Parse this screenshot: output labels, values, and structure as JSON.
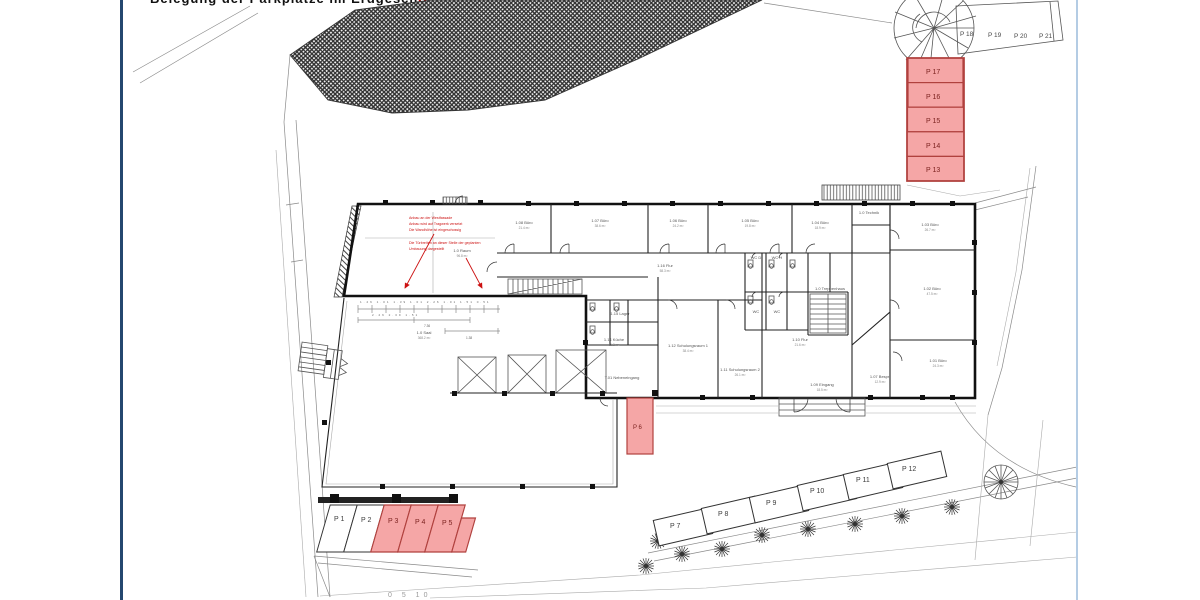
{
  "header": {
    "title_black_fragment": "Belegung der Parkplätze im Erdgeschoss,",
    "title_red_fragment": "rot markierte Stellplätze sind bereits vergeben",
    "scale_fragment": "0  5  10"
  },
  "colors": {
    "highlight_fill": "#f5a6a6",
    "highlight_stroke": "#b0413e",
    "highlight_text": "#7c2320",
    "annotation_red": "#cc1111",
    "left_border": "#24476f",
    "right_border": "#b4cce4",
    "line_dark": "#111111",
    "line_gray": "#8a8a8a"
  },
  "parking": {
    "top_row": [
      {
        "label": "P 18"
      },
      {
        "label": "P 19"
      },
      {
        "label": "P 20"
      },
      {
        "label": "P 21"
      }
    ],
    "right_stack": [
      {
        "label": "P 17"
      },
      {
        "label": "P 16"
      },
      {
        "label": "P 15"
      },
      {
        "label": "P 14"
      },
      {
        "label": "P 13"
      }
    ],
    "left_row": [
      {
        "label": "P 1"
      },
      {
        "label": "P 2"
      },
      {
        "label": "P 3"
      },
      {
        "label": "P 4"
      },
      {
        "label": "P 5"
      }
    ],
    "single_stall": {
      "label": "P 6"
    },
    "bottom_row": [
      {
        "label": "P 7"
      },
      {
        "label": "P 8"
      },
      {
        "label": "P 9"
      },
      {
        "label": "P 10"
      },
      {
        "label": "P 11"
      },
      {
        "label": "P 12"
      }
    ]
  },
  "annotation": {
    "line1": "Anbau an der Westfassade",
    "line2": "Anbau wird auf Tragwerk versetzt",
    "line3": "Die Wandhöhe ist eingeschossig",
    "line4": "Die Türbreiten an dieser Stelle der geplanten",
    "line5": "Umbauung dargestellt"
  },
  "dims": {
    "row_text": "1.26 1.01 1.39 1.01 2.26 1.01 1.51 0.51",
    "row2_text": "2.26  2.39  1.51",
    "total": "7.36",
    "extra": "1.38"
  },
  "rooms": [
    {
      "label": "1.08 Büro",
      "area": "21.4 m²"
    },
    {
      "label": "1.07 Büro",
      "area": "38.6 m²"
    },
    {
      "label": "1.06 Büro",
      "area": "24.2 m²"
    },
    {
      "label": "1.05 Büro",
      "area": "19.8 m²"
    },
    {
      "label": "1.04 Büro",
      "area": "18.9 m²"
    },
    {
      "label": "1.0 Technik",
      "area": "6.2 m²"
    },
    {
      "label": "1.03 Büro",
      "area": "26.7 m²"
    },
    {
      "label": "1.02 Büro",
      "area": "47.5 m²"
    },
    {
      "label": "1.01 Büro",
      "area": "24.3 m²"
    },
    {
      "label": "1.16 Flur",
      "area": "58.3 m²"
    },
    {
      "label": "1.15 Lager",
      "area": "7.4 m²"
    },
    {
      "label": "1.14 Küche",
      "area": "11.2 m²"
    },
    {
      "label": "1.12 Schulungsraum 1",
      "area": "38.4 m²"
    },
    {
      "label": "1.11 Schulungsraum 2",
      "area": "26.1 m²"
    },
    {
      "label": "1.10 Flur",
      "area": "21.6 m²"
    },
    {
      "label": "1.09 Eingang",
      "area": "18.5 m²"
    },
    {
      "label": "1.0 Treppenhaus",
      "area": "14.2 m²"
    },
    {
      "label": "1.07 Bespr.",
      "area": "12.9 m²"
    },
    {
      "label": "WC D",
      "area": ""
    },
    {
      "label": "WC H",
      "area": ""
    },
    {
      "label": "WC",
      "area": ""
    },
    {
      "label": "WC",
      "area": ""
    },
    {
      "label": "T.01 Nebeneingang",
      "area": "9.6 m²"
    },
    {
      "label": "1.0 Raum",
      "area": "96.8 m²"
    },
    {
      "label": "1.0 Saal",
      "area": "368.2 m²"
    }
  ]
}
